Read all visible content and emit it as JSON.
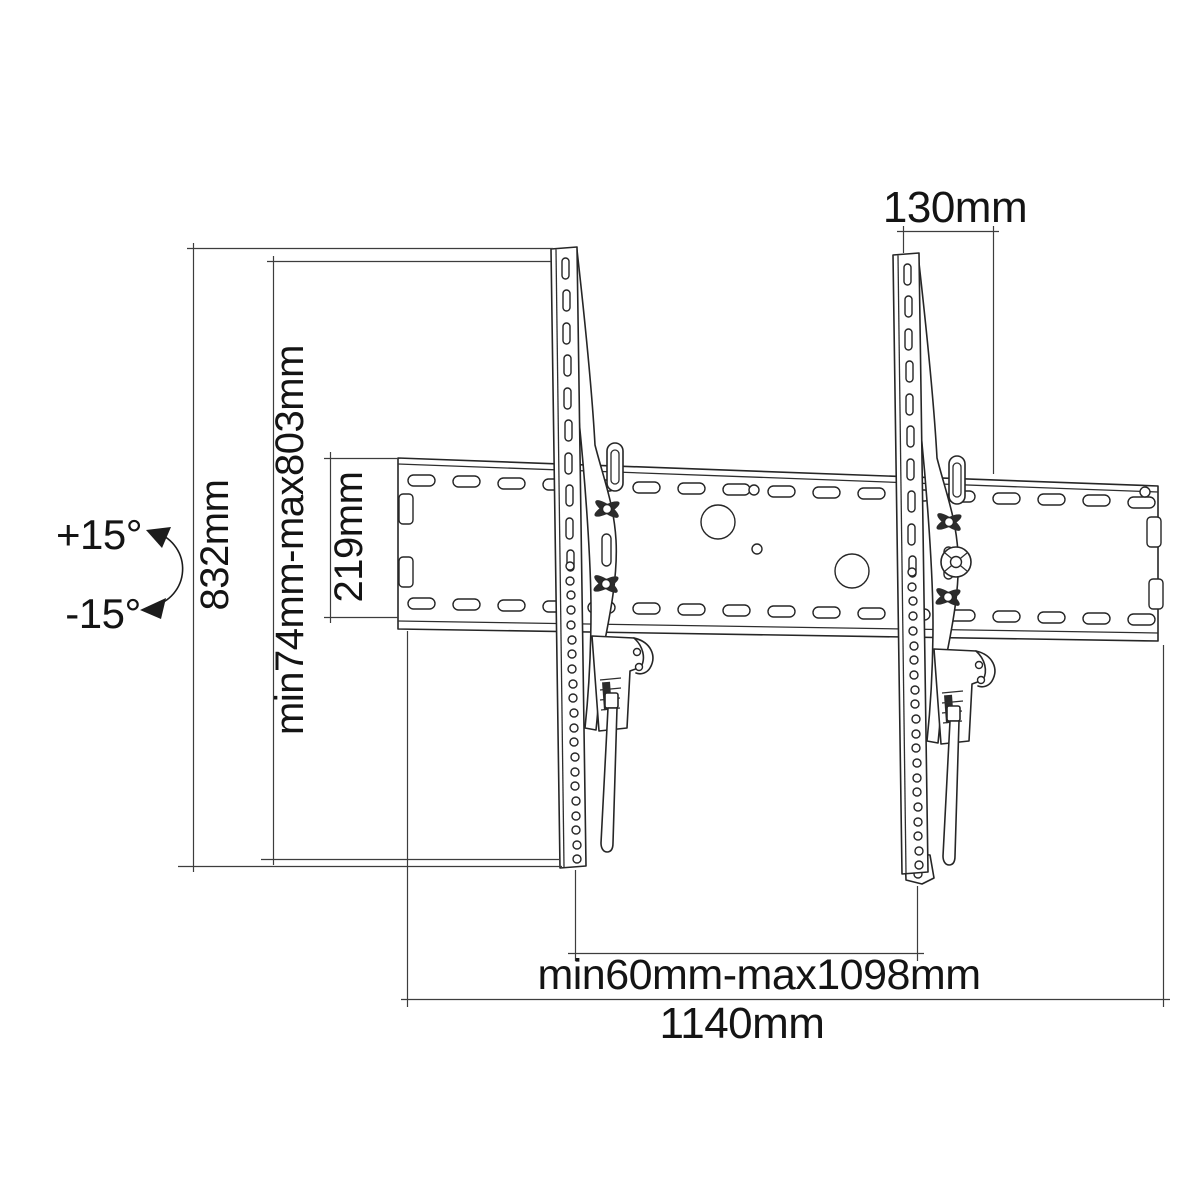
{
  "diagram": {
    "dimensions": {
      "bracket_height": "832mm",
      "vertical_adjust_range": "min74mm-max803mm",
      "wall_plate_height": "219mm",
      "bracket_top_offset": "130mm",
      "bracket_spacing_range": "min60mm-max1098mm",
      "total_width": "1140mm"
    },
    "tilt": {
      "up": "+15°",
      "down": "-15°"
    },
    "colors": {
      "background": "#ffffff",
      "drawing_line": "#262626",
      "dimension_line": "#3d3d3d",
      "text": "#141414"
    }
  }
}
